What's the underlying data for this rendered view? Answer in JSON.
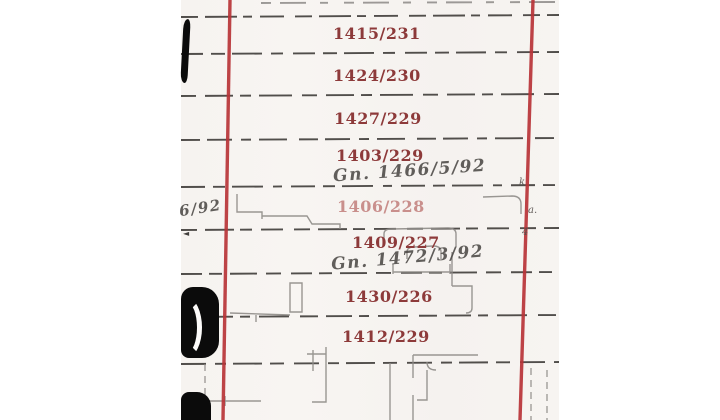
{
  "map": {
    "description_label": "scanned cadastral parcel plan",
    "parcels": [
      {
        "label": "1415/231"
      },
      {
        "label": "1424/230"
      },
      {
        "label": "1427/229"
      },
      {
        "label": "1403/229"
      },
      {
        "label": "1406/228"
      },
      {
        "label": "1409/227"
      },
      {
        "label": "1430/226"
      },
      {
        "label": "1412/229"
      }
    ],
    "handwriting": {
      "note1": "Gn. 1466/5/92",
      "note2": "Gn. 1472/3/92",
      "margin_note": "6/92"
    },
    "margin_marks": {
      "right_top": "k",
      "right_mid": "a.",
      "right_low": "4",
      "left_arrow": "◄"
    },
    "colors": {
      "boundary_red": "#b93438",
      "label_red": "#8d3a3a",
      "label_faded_pink": "#c98f8c",
      "survey_ink": "#35322f",
      "pencil": "#8f8c88",
      "paper": "#f7f4f1",
      "ink_black": "#0b0b0b"
    }
  }
}
